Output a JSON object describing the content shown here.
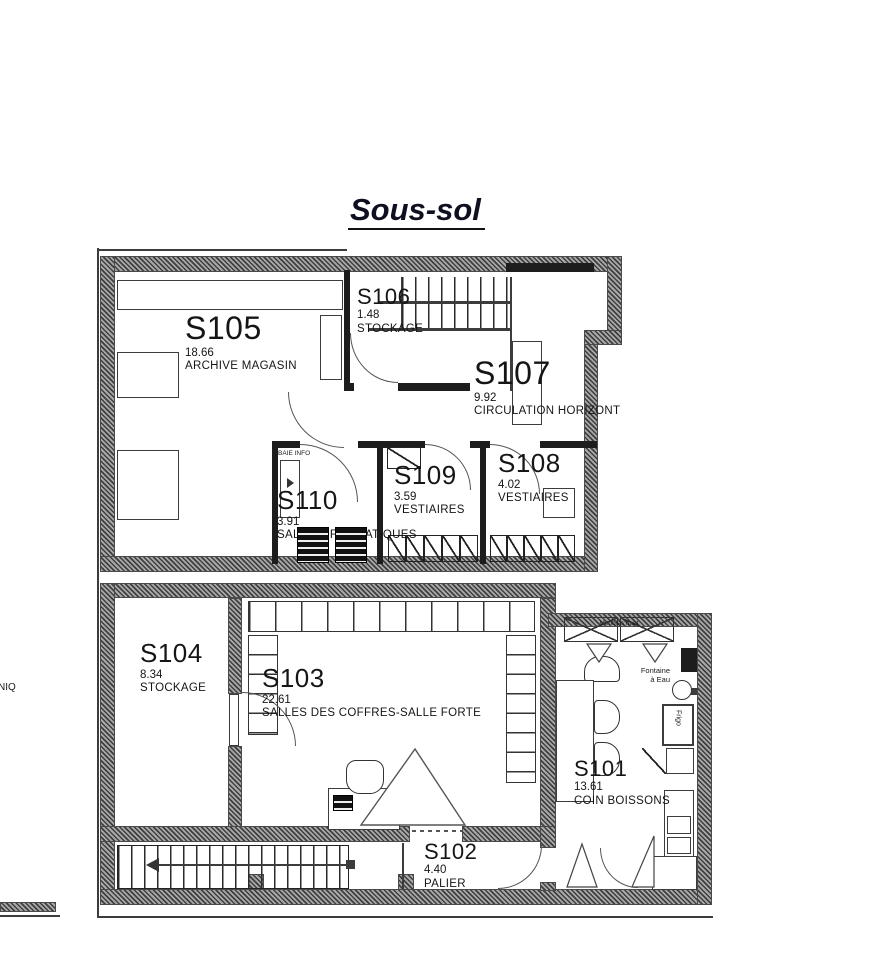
{
  "title": "Sous-sol",
  "rooms": [
    {
      "code": "S105",
      "area": "18.66",
      "name": "ARCHIVE MAGASIN"
    },
    {
      "code": "S106",
      "area": "1.48",
      "name": "STOCKAGE"
    },
    {
      "code": "S107",
      "area": "9.92",
      "name": "CIRCULATION HORIZONT"
    },
    {
      "code": "S108",
      "area": "4.02",
      "name": "VESTIAIRES"
    },
    {
      "code": "S109",
      "area": "3.59",
      "name": "VESTIAIRES"
    },
    {
      "code": "S110",
      "area": "3.91",
      "name": "SALLE INFORMATIQUES"
    },
    {
      "code": "S104",
      "area": "8.34",
      "name": "STOCKAGE"
    },
    {
      "code": "S103",
      "area": "22.61",
      "name": "SALLES DES COFFRES-SALLE FORTE"
    },
    {
      "code": "S102",
      "area": "4.40",
      "name": "PALIER"
    },
    {
      "code": "S101",
      "area": "13.61",
      "name": "COIN BOISSONS"
    }
  ],
  "annotations": {
    "baie_info": "BAIE INFO",
    "meubles_haut": "Meubles haut",
    "fontaine_1": "Fontaine",
    "fontaine_2": "à Eau",
    "frigo": "Frigo",
    "edge_text": "NIQ"
  },
  "colors": {
    "wall_dark": "#3f3f3f",
    "wall_light": "#a8a8a8",
    "line": "#222222",
    "text": "#151515"
  }
}
